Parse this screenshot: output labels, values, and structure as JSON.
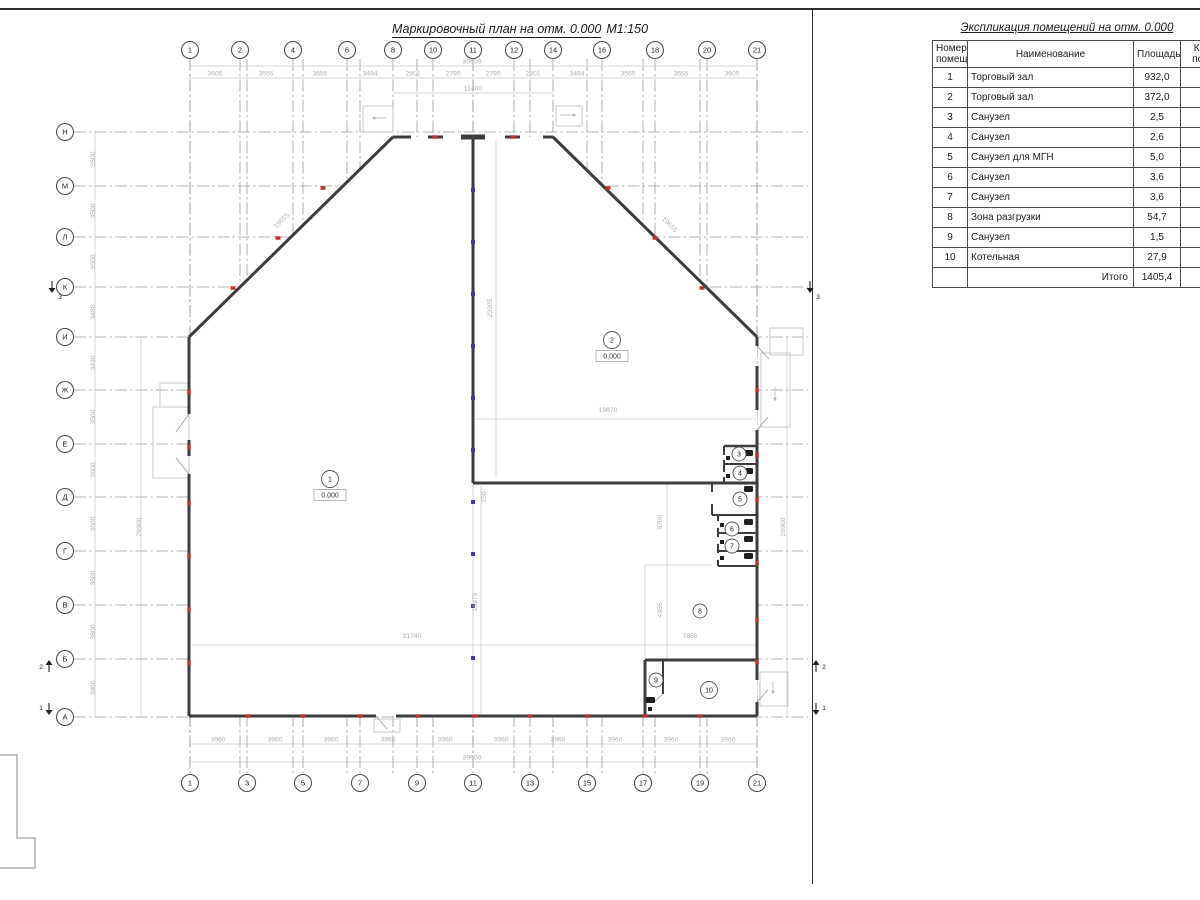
{
  "titles": {
    "plan_title": "Маркировочный план на отм. 0.000",
    "plan_scale": "М1:150"
  },
  "schedule": {
    "title": "Экспликация помещений на отм. 0.000",
    "headers": {
      "num": "Номер помещ.",
      "name": "Наименование",
      "area": "Площадь",
      "cat": "Кат. пом."
    },
    "rows": [
      {
        "num": "1",
        "name": "Торговый зал",
        "area": "932,0"
      },
      {
        "num": "2",
        "name": "Торговый зал",
        "area": "372,0"
      },
      {
        "num": "3",
        "name": "Санузел",
        "area": "2,5"
      },
      {
        "num": "4",
        "name": "Санузел",
        "area": "2,6"
      },
      {
        "num": "5",
        "name": "Санузел для МГН",
        "area": "5,0"
      },
      {
        "num": "6",
        "name": "Санузел",
        "area": "3,6"
      },
      {
        "num": "7",
        "name": "Санузел",
        "area": "3,6"
      },
      {
        "num": "8",
        "name": "Зона разгрузки",
        "area": "54,7"
      },
      {
        "num": "9",
        "name": "Санузел",
        "area": "1,5"
      },
      {
        "num": "10",
        "name": "Котельная",
        "area": "27,9"
      }
    ],
    "total_label": "Итого",
    "total_value": "1405,4"
  },
  "plan": {
    "axes_top": [
      {
        "label": "1",
        "x": 190
      },
      {
        "label": "2",
        "x": 240
      },
      {
        "label": "4",
        "x": 293
      },
      {
        "label": "6",
        "x": 347
      },
      {
        "label": "8",
        "x": 393
      },
      {
        "label": "10",
        "x": 433
      },
      {
        "label": "11",
        "x": 473
      },
      {
        "label": "12",
        "x": 514
      },
      {
        "label": "14",
        "x": 553
      },
      {
        "label": "16",
        "x": 602
      },
      {
        "label": "18",
        "x": 655
      },
      {
        "label": "20",
        "x": 707
      },
      {
        "label": "21",
        "x": 757
      }
    ],
    "axes_bottom": [
      {
        "label": "1",
        "x": 190
      },
      {
        "label": "3",
        "x": 247
      },
      {
        "label": "5",
        "x": 303
      },
      {
        "label": "7",
        "x": 360
      },
      {
        "label": "9",
        "x": 417
      },
      {
        "label": "11",
        "x": 473
      },
      {
        "label": "13",
        "x": 530
      },
      {
        "label": "15",
        "x": 587
      },
      {
        "label": "17",
        "x": 643
      },
      {
        "label": "19",
        "x": 700
      },
      {
        "label": "21",
        "x": 757
      }
    ],
    "axes_left": [
      {
        "label": "Н",
        "y": 132
      },
      {
        "label": "М",
        "y": 186
      },
      {
        "label": "Л",
        "y": 237
      },
      {
        "label": "К",
        "y": 287
      },
      {
        "label": "И",
        "y": 337
      },
      {
        "label": "Ж",
        "y": 390
      },
      {
        "label": "Е",
        "y": 444
      },
      {
        "label": "Д",
        "y": 497
      },
      {
        "label": "Г",
        "y": 551
      },
      {
        "label": "В",
        "y": 605
      },
      {
        "label": "Б",
        "y": 659
      },
      {
        "label": "А",
        "y": 717
      }
    ],
    "dims": [
      {
        "t": "3605",
        "x": 215,
        "y": 75.5
      },
      {
        "t": "3555",
        "x": 266,
        "y": 75.5
      },
      {
        "t": "3555",
        "x": 320,
        "y": 75.5
      },
      {
        "t": "3494",
        "x": 370,
        "y": 75.5
      },
      {
        "t": "2801",
        "x": 413,
        "y": 75.5
      },
      {
        "t": "2790",
        "x": 453,
        "y": 75.5
      },
      {
        "t": "2790",
        "x": 493,
        "y": 75.5
      },
      {
        "t": "2801",
        "x": 533,
        "y": 75.5
      },
      {
        "t": "3494",
        "x": 577,
        "y": 75.5
      },
      {
        "t": "3555",
        "x": 628,
        "y": 75.5
      },
      {
        "t": "3555",
        "x": 681,
        "y": 75.5
      },
      {
        "t": "3605",
        "x": 732,
        "y": 75.5
      },
      {
        "t": "39600",
        "x": 472,
        "y": 63.5
      },
      {
        "t": "11400",
        "x": 473,
        "y": 90.5
      },
      {
        "t": "3960",
        "x": 218,
        "y": 741.5
      },
      {
        "t": "3960",
        "x": 275,
        "y": 741.5
      },
      {
        "t": "3960",
        "x": 331,
        "y": 741.5
      },
      {
        "t": "3960",
        "x": 388,
        "y": 741.5
      },
      {
        "t": "3960",
        "x": 445,
        "y": 741.5
      },
      {
        "t": "3960",
        "x": 501,
        "y": 741.5
      },
      {
        "t": "3960",
        "x": 558,
        "y": 741.5
      },
      {
        "t": "3960",
        "x": 615,
        "y": 741.5
      },
      {
        "t": "3960",
        "x": 671,
        "y": 741.5
      },
      {
        "t": "3960",
        "x": 728,
        "y": 741.5
      },
      {
        "t": "39600",
        "x": 472,
        "y": 759.5
      },
      {
        "t": "3500",
        "x": 95,
        "y": 159,
        "r": -90
      },
      {
        "t": "3500",
        "x": 95,
        "y": 211,
        "r": -90
      },
      {
        "t": "3500",
        "x": 95,
        "y": 262,
        "r": -90
      },
      {
        "t": "3480",
        "x": 95,
        "y": 312,
        "r": -90
      },
      {
        "t": "3490",
        "x": 95,
        "y": 363,
        "r": -90
      },
      {
        "t": "3500",
        "x": 95,
        "y": 417,
        "r": -90
      },
      {
        "t": "3600",
        "x": 95,
        "y": 470,
        "r": -90
      },
      {
        "t": "3600",
        "x": 95,
        "y": 524,
        "r": -90
      },
      {
        "t": "3600",
        "x": 95,
        "y": 578,
        "r": -90
      },
      {
        "t": "3600",
        "x": 95,
        "y": 632,
        "r": -90
      },
      {
        "t": "3960",
        "x": 95,
        "y": 688,
        "r": -90
      },
      {
        "t": "26900",
        "x": 141,
        "y": 527,
        "r": -90
      },
      {
        "t": "26900",
        "x": 785,
        "y": 527,
        "r": -90
      },
      {
        "t": "19655",
        "x": 283,
        "y": 222,
        "r": -45
      },
      {
        "t": "19655",
        "x": 668,
        "y": 226,
        "r": 45
      },
      {
        "t": "23985",
        "x": 492,
        "y": 308,
        "r": -90
      },
      {
        "t": "19870",
        "x": 608,
        "y": 412
      },
      {
        "t": "150",
        "x": 486,
        "y": 497,
        "r": -90
      },
      {
        "t": "31740",
        "x": 412,
        "y": 638
      },
      {
        "t": "16975",
        "x": 477,
        "y": 602,
        "r": -90
      },
      {
        "t": "7860",
        "x": 690,
        "y": 638
      },
      {
        "t": "5700",
        "x": 662,
        "y": 522,
        "r": -90
      },
      {
        "t": "4955",
        "x": 662,
        "y": 610,
        "r": -90
      }
    ],
    "rooms": [
      {
        "n": "1",
        "x": 330,
        "y": 479,
        "elev": "0,000",
        "big": true
      },
      {
        "n": "2",
        "x": 612,
        "y": 340,
        "elev": "0,000",
        "big": true
      },
      {
        "n": "3",
        "x": 739,
        "y": 454
      },
      {
        "n": "4",
        "x": 740,
        "y": 473
      },
      {
        "n": "5",
        "x": 740,
        "y": 499
      },
      {
        "n": "6",
        "x": 732,
        "y": 529
      },
      {
        "n": "7",
        "x": 732,
        "y": 546
      },
      {
        "n": "8",
        "x": 700,
        "y": 611
      },
      {
        "n": "9",
        "x": 656,
        "y": 680
      },
      {
        "n": "10",
        "x": 709,
        "y": 690,
        "big": true
      }
    ],
    "section_marks": [
      {
        "n": "3",
        "x": 52,
        "y": 290,
        "d": "down",
        "tx": 60,
        "ty": 299
      },
      {
        "n": "3",
        "x": 810,
        "y": 290,
        "d": "down",
        "tx": 818,
        "ty": 299
      },
      {
        "n": "2",
        "x": 49,
        "y": 663,
        "d": "up",
        "tx": 41,
        "ty": 669
      },
      {
        "n": "2",
        "x": 816,
        "y": 663,
        "d": "up",
        "tx": 824,
        "ty": 669
      },
      {
        "n": "1",
        "x": 49,
        "y": 712,
        "d": "down",
        "tx": 41,
        "ty": 710
      },
      {
        "n": "1",
        "x": 816,
        "y": 712,
        "d": "down",
        "tx": 824,
        "ty": 710
      }
    ]
  }
}
